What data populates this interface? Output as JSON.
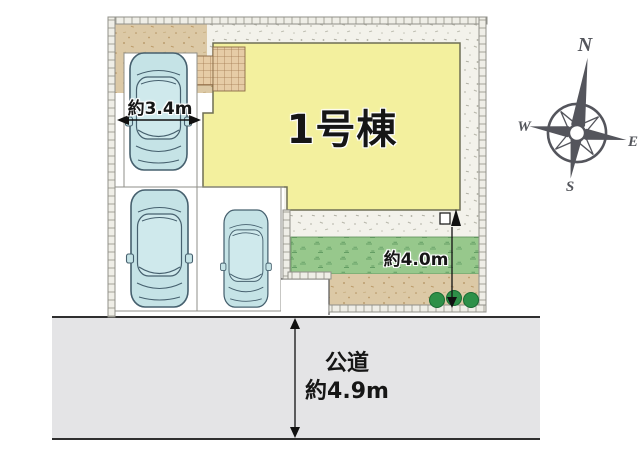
{
  "plan": {
    "building_label": "1号棟",
    "parking_width_label": "約3.4m",
    "garden_depth_label": "約4.0m",
    "road": {
      "name": "公道",
      "width_label": "約4.9m"
    },
    "compass": {
      "north": "N",
      "east": "E",
      "south": "S",
      "west": "W"
    },
    "car_count": 3,
    "tree_count": 3,
    "colors": {
      "building_fill": "#f3f09e",
      "building_stroke": "#6e6e54",
      "car_fill": "#c5e3e6",
      "car_stroke": "#46606e",
      "grass_fill": "#97c88c",
      "road_fill": "#e4e4e6",
      "approach_tan": "#dcc9a6",
      "tile_tan": "#e6cca6",
      "compass_gray": "#54555c",
      "tree_green": "#2e9048",
      "lot_ground": "#f3f2eb"
    }
  }
}
